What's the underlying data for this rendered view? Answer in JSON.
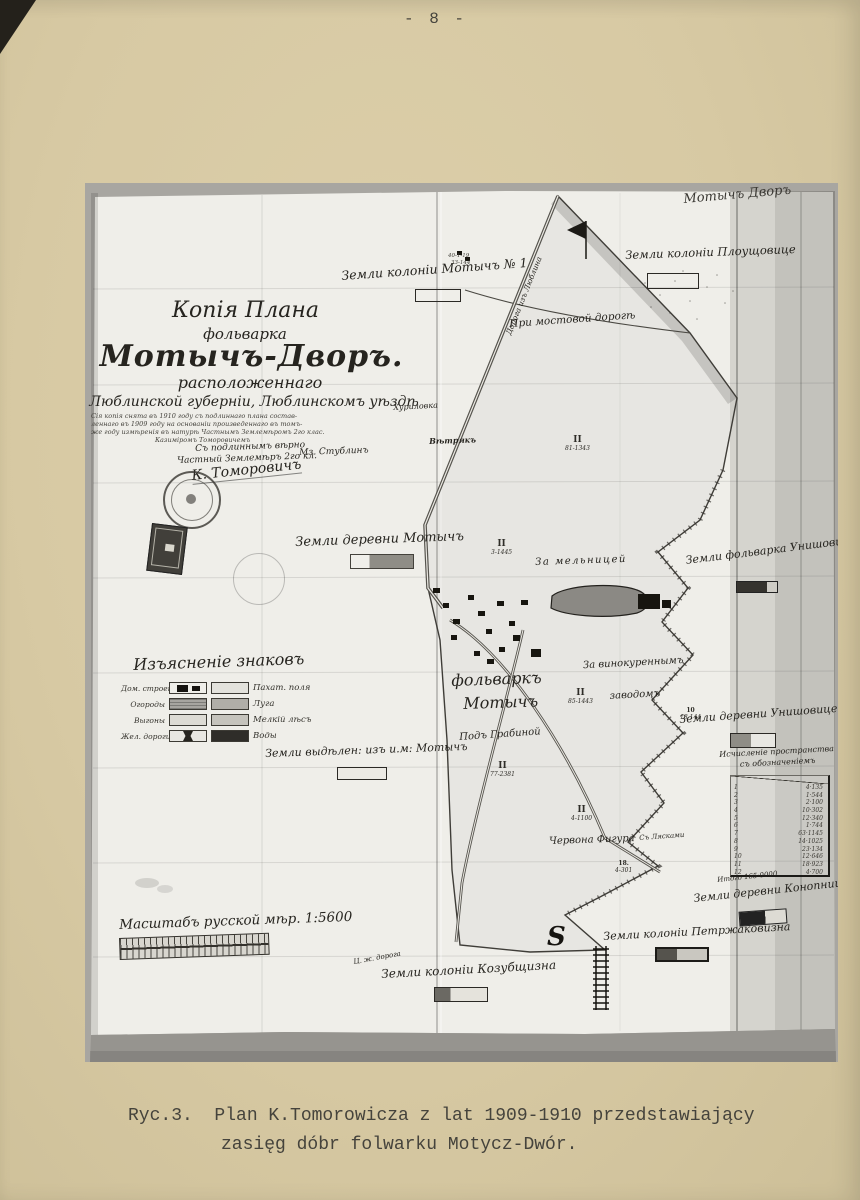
{
  "page": {
    "number": "- 8 -",
    "caption_line1": "Ryc.3.  Plan K.Tomorowicza z lat 1909-1910 przedstawiający",
    "caption_line2": "zasięg dóbr folwarku Motycz-Dwór."
  },
  "colors": {
    "page_paper": "#d7c9a3",
    "photo_margin": "#a8a6a1",
    "map_paper": "#efeee9",
    "ink": "#2a2823"
  },
  "map": {
    "corner_note": "Мотычъ Дворъ",
    "s_mark": "S",
    "tiny_notes": [
      "40-1-19",
      "33-144"
    ],
    "title": {
      "line1": "Копія Плана",
      "line2": "фольварка",
      "line3": "Мотычъ-Дворъ.",
      "line4": "расположеннаго",
      "line5": "Люблинской губерніи, Люблинскомъ уѣздѣ",
      "note1": "Сія копія снята въ 1910 году съ подлиннаго плана состав-",
      "note2": "леннаго въ 1909 году на основаніи произведеннаго въ томъ-",
      "note3": "же году измѣренія въ натурѣ Частнымъ Землемѣромъ 2го клас.",
      "note4": "Казиміромъ Томоровичемъ",
      "certify1": "Съ подлиннымъ вѣрно",
      "certify2": "Частный Землемѣръ 2го кл.",
      "signature": "К. Томоровичъ"
    },
    "labels": {
      "road_note": "Дорога изъ Люблина",
      "kolonia_motycz1": "Земли колоніи Мотычъ № 1",
      "kolonia_plouszowice": "Земли колоніи Плоущовице",
      "pri_mostovoy": "При мостовой дорогѣ",
      "khurilovka": "Хуриловка",
      "vetryak": "Вѣтрякъ",
      "mz_stublin": "Мз. Стублинъ",
      "derevnya_motycz": "Земли деревни Мотычъ",
      "za_melnitsey": "За мельницей",
      "folwark_uniszowice": "Земли фольварка Унишовице",
      "za_vinokurennym_1": "За винокуреннымъ",
      "za_vinokurennym_2": "заводомъ",
      "folwark_motycz_1": "фольваркъ",
      "folwark_motycz_2": "Мотычъ",
      "derevnya_uniszowice": "Земли деревни Унишовице",
      "vydelennye": "Земли выдѣлен: изъ и.м: Мотычъ",
      "pod_grabinoy": "Подъ Грабиной",
      "czerwona_figura": "Червона Фигура",
      "s_lyaskami": "Съ Лясками",
      "derevnya_konopnica": "Земли деревни Конопница",
      "kolonia_petrzakowizna": "Земли колоніи Петржаковизна",
      "kolonia_kozubszczyzna": "Земли колоніи Козубщизна",
      "railway_small": "Ц. ж. дорога"
    },
    "legend": {
      "title": "Изъясненіе знаковъ",
      "rows": [
        {
          "left": "Дом. строенія",
          "right": "Пахат. поля"
        },
        {
          "left": "Огороды",
          "right": "Луга"
        },
        {
          "left": "Выгоны",
          "right": "Мелкій лѣсъ"
        },
        {
          "left": "Жел. дороги",
          "right": "Воды"
        }
      ]
    },
    "scale_label": "Масштабъ русской мѣр. 1:5600",
    "area_table": {
      "heading1": "Исчисленіе пространства",
      "heading2": "съ обозначеніемъ",
      "rows": [
        {
          "n": "1",
          "v": "4·135"
        },
        {
          "n": "2",
          "v": "1·544"
        },
        {
          "n": "3",
          "v": "2·100"
        },
        {
          "n": "4",
          "v": "10·302"
        },
        {
          "n": "5",
          "v": "12·340"
        },
        {
          "n": "6",
          "v": "1·744"
        },
        {
          "n": "7",
          "v": "63·1145"
        },
        {
          "n": "8",
          "v": "14·1025"
        },
        {
          "n": "9",
          "v": "23·134"
        },
        {
          "n": "10",
          "v": "12·646"
        },
        {
          "n": "11",
          "v": "18·923"
        },
        {
          "n": "12",
          "v": "4·700"
        }
      ],
      "total": "Итого 165·0000"
    },
    "markers": [
      {
        "n": "II",
        "v": "81-1343"
      },
      {
        "n": "II",
        "v": "3-1445"
      },
      {
        "n": "II",
        "v": "85-1443"
      },
      {
        "n": "II",
        "v": "77-2381"
      },
      {
        "n": "II",
        "v": "4-1100"
      },
      {
        "n": "10",
        "v": "18-144"
      },
      {
        "n": "18.",
        "v": "4-301"
      }
    ]
  }
}
